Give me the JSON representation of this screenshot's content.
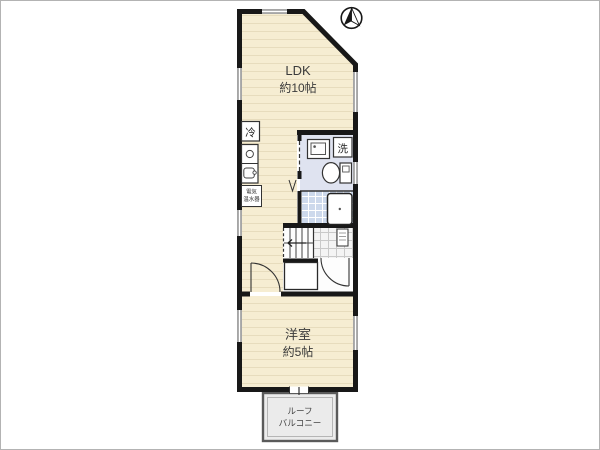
{
  "document": {
    "type": "floor-plan",
    "border_color": "#b3b3b3",
    "background": "#ffffff"
  },
  "colors": {
    "wall": "#181818",
    "floor": "#f6edd2",
    "floor_stripe": "#e7dcbd",
    "wet_area_floor": "#dfe3f0",
    "bath_tile": "#cdd9ec",
    "entry_tile": "#f4f4f4",
    "balcony": "#ebebeb",
    "window": "#a6a6a6",
    "text": "#3b3b3b"
  },
  "rooms": {
    "ldk": {
      "name": "LDK",
      "size": "約10帖"
    },
    "western_room": {
      "name": "洋室",
      "size": "約5帖"
    },
    "balcony": {
      "name_line1": "ルーフ",
      "name_line2": "バルコニー"
    }
  },
  "fixtures": {
    "refrigerator": {
      "label": "冷"
    },
    "washing_machine": {
      "label": "洗"
    },
    "water_heater": {
      "label_line1": "電気",
      "label_line2": "温水器"
    }
  },
  "icons": {
    "north_arrow": "north-arrow-icon",
    "stove": "stove-icon",
    "sink": "sink-icon",
    "washbasin": "washbasin-icon",
    "toilet": "toilet-icon",
    "bathtub": "bathtub-icon",
    "stairs": "staircase",
    "meter_box": "meter-box",
    "doors": [
      "door-arc-western-room",
      "door-arc-entry",
      "sliding-door-dashed",
      "folding-door-icon"
    ]
  }
}
